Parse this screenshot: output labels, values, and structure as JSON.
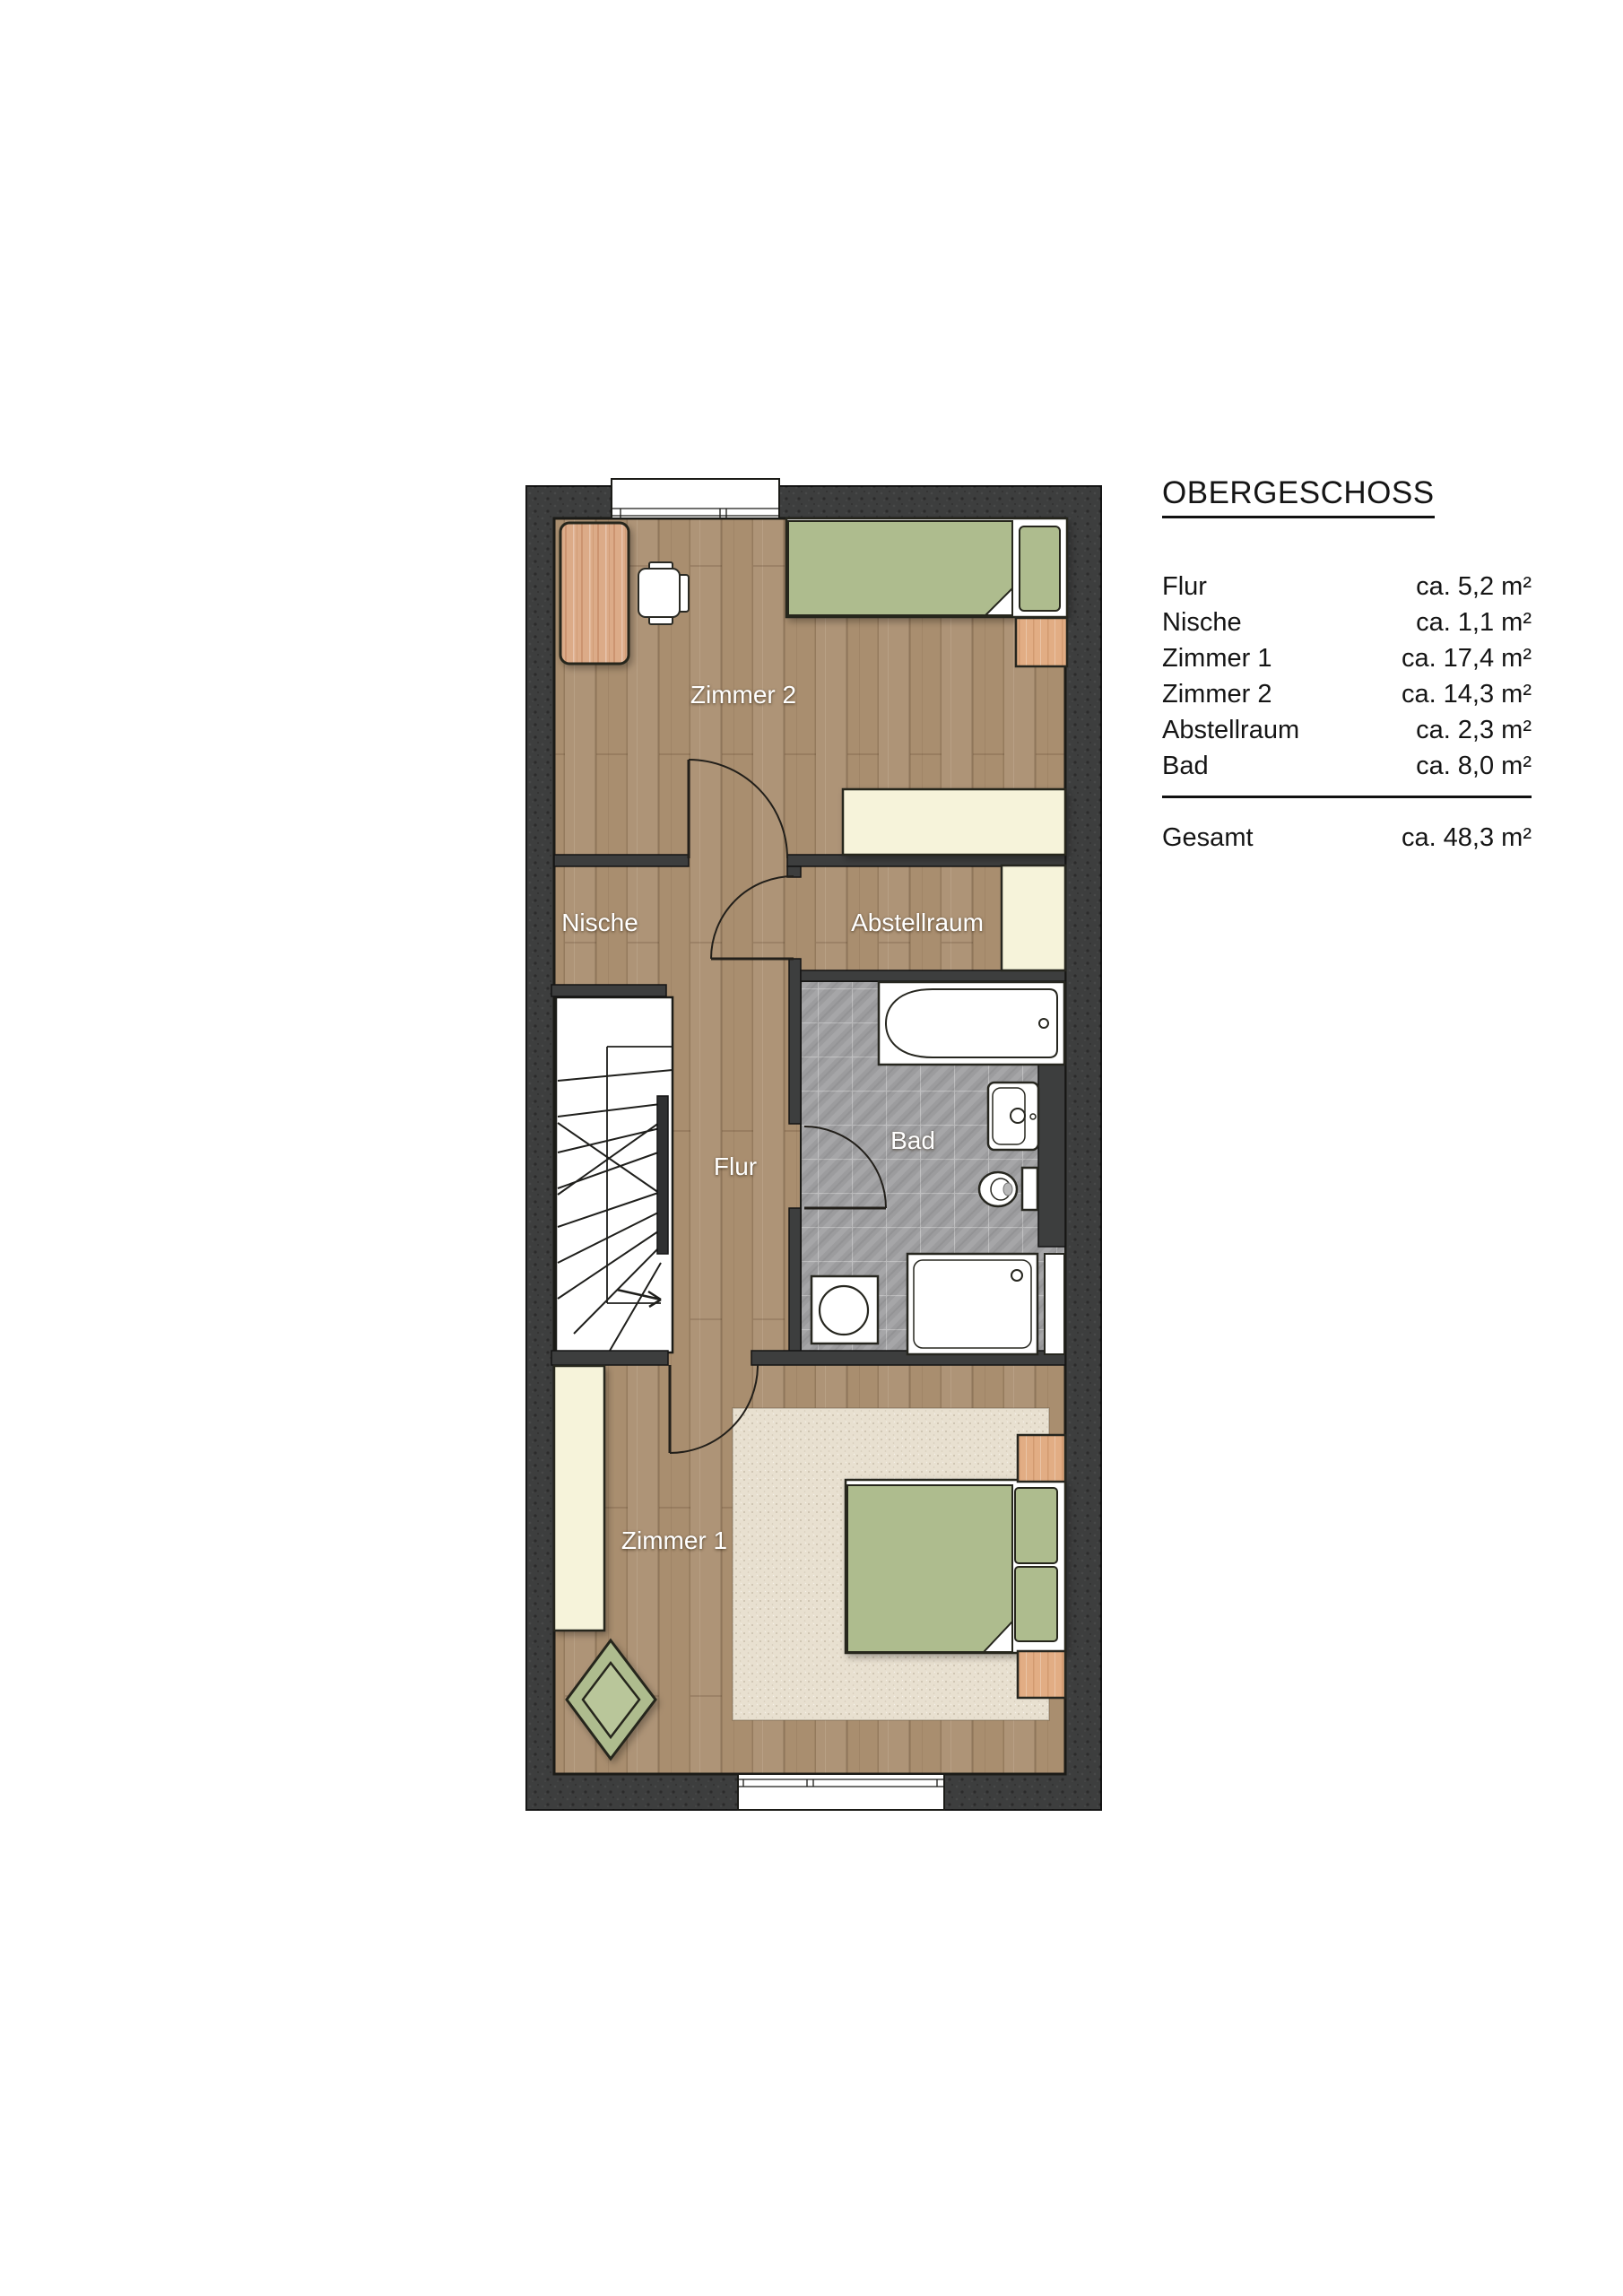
{
  "legend": {
    "title": "OBERGESCHOSS",
    "rows": [
      {
        "label": "Flur",
        "value": "ca. 5,2 m²"
      },
      {
        "label": "Nische",
        "value": "ca. 1,1 m²"
      },
      {
        "label": "Zimmer 1",
        "value": "ca. 17,4 m²"
      },
      {
        "label": "Zimmer 2",
        "value": "ca. 14,3 m²"
      },
      {
        "label": "Abstellraum",
        "value": "ca. 2,3 m²"
      },
      {
        "label": "Bad",
        "value": "ca. 8,0 m²"
      }
    ],
    "total": {
      "label": "Gesamt",
      "value": "ca. 48,3 m²"
    }
  },
  "plan": {
    "rooms": [
      {
        "id": "zimmer2",
        "label": "Zimmer 2"
      },
      {
        "id": "nische",
        "label": "Nische"
      },
      {
        "id": "abstellraum",
        "label": "Abstellraum"
      },
      {
        "id": "flur",
        "label": "Flur"
      },
      {
        "id": "bad",
        "label": "Bad"
      },
      {
        "id": "zimmer1",
        "label": "Zimmer 1"
      }
    ],
    "colors": {
      "wall": "#3d3e3e",
      "wood_floor": "#a98e6f",
      "tile_floor": "#9c9c9e",
      "furniture_green": "#aebc8e",
      "cream": "#f6f3da",
      "rug": "#e8e0d0",
      "outline": "#26261f",
      "room_label_text": "#ffffff",
      "legend_text": "#151515"
    }
  }
}
